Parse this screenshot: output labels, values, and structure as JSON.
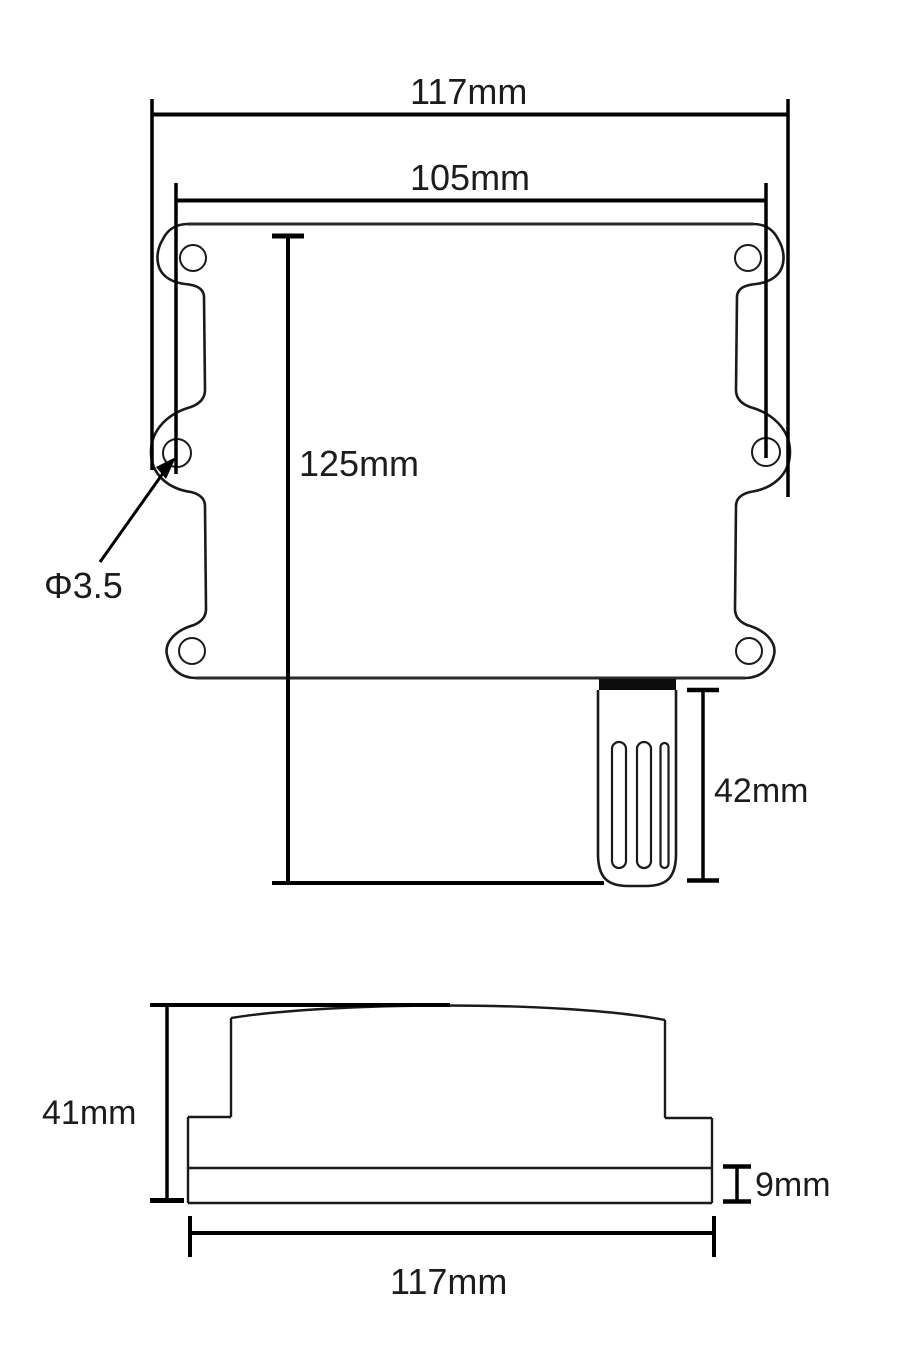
{
  "page": {
    "background": "#ffffff",
    "line_color": "#1a1a1a",
    "dimension_line_color": "#000000"
  },
  "front_view": {
    "labels": {
      "overall_width": "117mm",
      "inner_width": "105mm",
      "body_height": "125mm",
      "hole_diameter": "Φ3.5",
      "probe_length": "42mm"
    }
  },
  "side_view": {
    "labels": {
      "overall_height": "41mm",
      "base_thickness": "9mm",
      "overall_width": "117mm"
    }
  }
}
